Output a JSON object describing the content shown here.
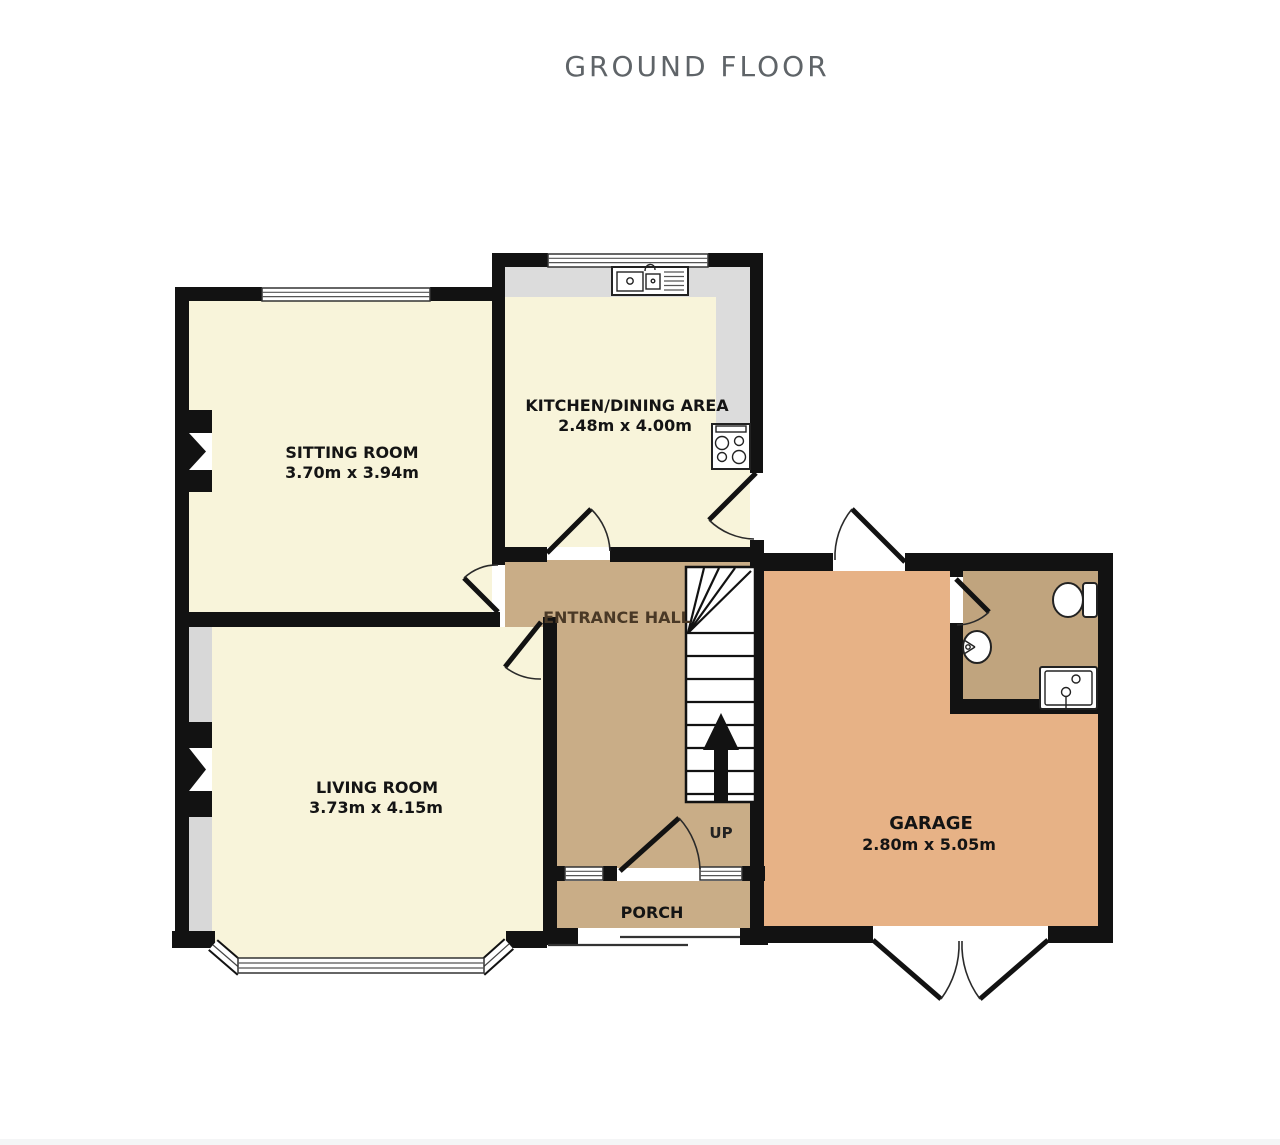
{
  "title": "GROUND FLOOR",
  "rooms": {
    "sitting": {
      "name": "SITTING ROOM",
      "dims": "3.70m  x 3.94m"
    },
    "kitchen": {
      "name": "KITCHEN/DINING AREA",
      "dims": "2.48m  x 4.00m"
    },
    "living": {
      "name": "LIVING ROOM",
      "dims": "3.73m  x 4.15m"
    },
    "hall": {
      "name": "ENTRANCE HALL"
    },
    "porch": {
      "name": "PORCH"
    },
    "garage": {
      "name": "GARAGE",
      "dims": "2.80m  x 5.05m"
    },
    "stairs": {
      "up_label": "UP"
    }
  },
  "colors": {
    "floor_cream": "#f8f4da",
    "hall_tan": "#c9ad87",
    "garage_orange": "#e7b286",
    "wc_brown": "#c0a47e",
    "wall_black": "#121212",
    "counter_gray": "#dcdcdc",
    "alcove_gray": "#d8d8d8",
    "title_gray": "#5f6468",
    "hall_label_brown": "#4a3926",
    "background": "#ffffff"
  }
}
